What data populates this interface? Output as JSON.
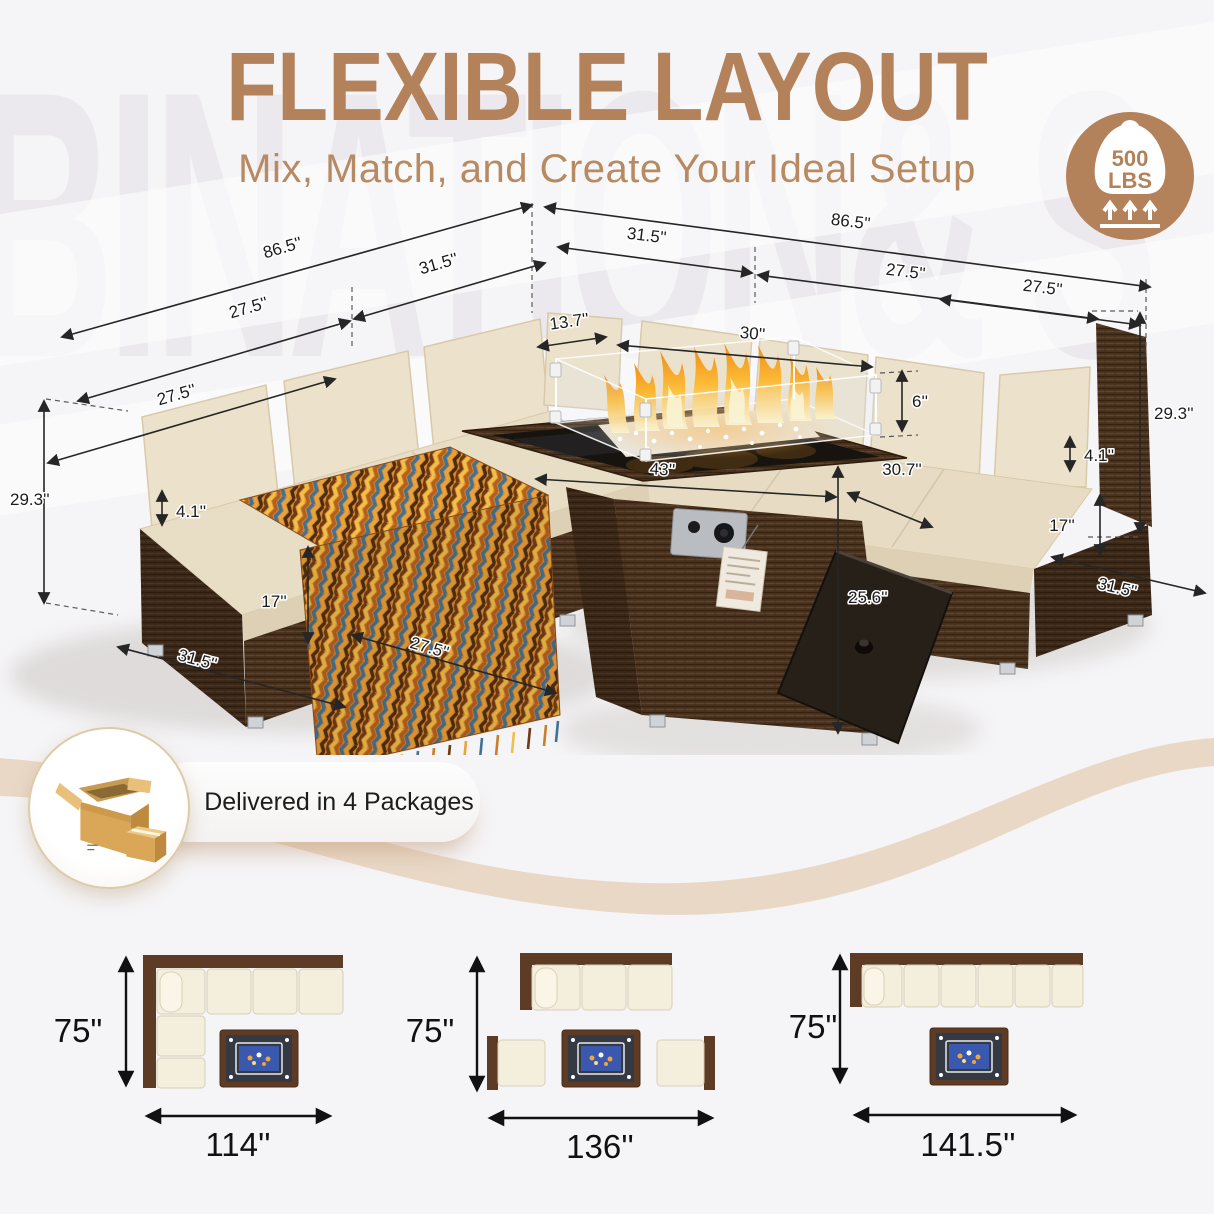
{
  "watermark": "BINATION& S",
  "header": {
    "title": "FLEXIBLE LAYOUT",
    "subtitle": "Mix, Match, and Create Your Ideal Setup"
  },
  "capacity_badge": {
    "value": "500",
    "unit": "LBS"
  },
  "delivery": {
    "label": "Delivered in 4 Packages"
  },
  "scene": {
    "dims": {
      "left_total": "86.5''",
      "left_corner": "31.5''",
      "left_seat_mid": "27.5''",
      "left_seat_low": "27.5''",
      "right_total": "86.5''",
      "right_corner": "31.5''",
      "right_seat_mid": "27.5''",
      "right_seat_low": "27.5''",
      "glass_depth": "13.7''",
      "glass_width": "30''",
      "glass_height": "6''",
      "table_width": "43''",
      "table_depth": "30.7''",
      "lid_length": "25.6''",
      "left_height": "29.3''",
      "left_cushion": "4.1''",
      "left_base": "17''",
      "left_depth": "31.5''",
      "left_seat_front": "27.5''",
      "right_height": "29.3''",
      "right_cushion": "4.1''",
      "right_base": "17''",
      "right_depth": "31.5''"
    }
  },
  "layouts": [
    {
      "id": "l-shaped-sectional",
      "height_label": "75\"",
      "width_label": "114''"
    },
    {
      "id": "sofa-with-two-chairs",
      "height_label": "75\"",
      "width_label": "136''"
    },
    {
      "id": "straight-sofa",
      "height_label": "75\"",
      "width_label": "141.5''"
    }
  ],
  "colors": {
    "accent": "#b3815a",
    "wicker": "#4a3220",
    "cushion": "#eadfc8",
    "flame": "#f59d22",
    "fire_glass_blue": "#3a58ae",
    "wave_tan": "#e9d8c6"
  }
}
